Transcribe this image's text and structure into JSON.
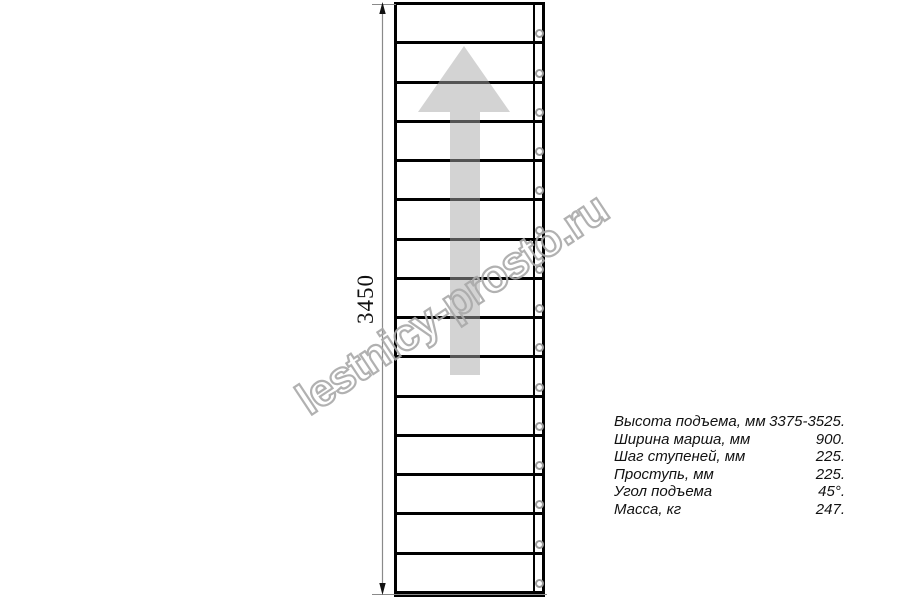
{
  "page": {
    "background": "#ffffff"
  },
  "drawing": {
    "type": "staircase-plan-top-view",
    "steps_count": 15,
    "dimension_label": "3450",
    "direction_arrow": "up",
    "colors": {
      "line": "#000000",
      "dimension_line": "#8a8a8a",
      "dimension_arrowhead": "#111111",
      "hole_ring": "#9a9a9a",
      "arrow_fill": "rgba(168,168,168,0.5)",
      "watermark_stroke": "#a9a9a9"
    }
  },
  "watermark": {
    "text": "lestnicy-prosto.ru"
  },
  "specs": {
    "rows": [
      {
        "label": "Высота подъема, мм",
        "value": "3375-3525."
      },
      {
        "label": "Ширина марша, мм",
        "value": "900."
      },
      {
        "label": "Шаг ступеней, мм",
        "value": "225."
      },
      {
        "label": "Проступь, мм",
        "value": "225."
      },
      {
        "label": "Угол подъема",
        "value": "45°."
      },
      {
        "label": "Масса, кг",
        "value": "247."
      }
    ]
  }
}
